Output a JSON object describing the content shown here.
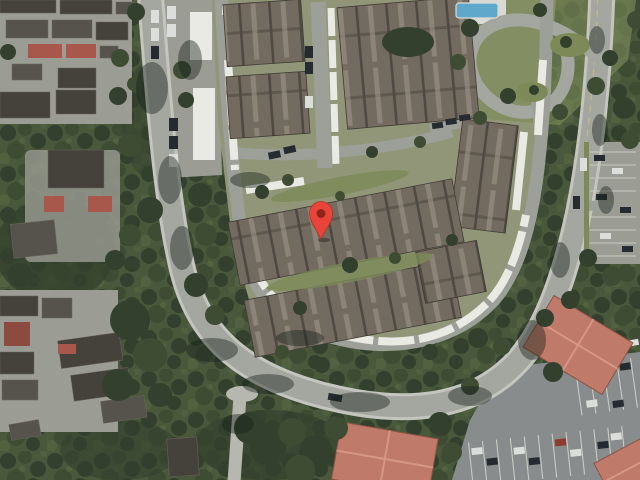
{
  "map": {
    "view_mode": "satellite",
    "marker": {
      "x": 321,
      "y": 239
    },
    "palette": {
      "canopy-base": "#49573b",
      "canopy-dark": "#33402e",
      "canopy-mid": "#3e4c34",
      "canopy-light": "#5b6b45",
      "lawn": "#7d8a58",
      "complex-lawn": "#929678",
      "curb": "#c3c5be",
      "road": "#a4a7a0",
      "road2": "#9da099",
      "path": "#b6b7af",
      "pavement": "#9b9c93",
      "asphalt": "#888c8c",
      "carport": "#e9eae3",
      "roof-main": "#746b60",
      "roof-dark": "#4e4942",
      "roof-light": "#9c9488",
      "roof-outline": "#3f3b35",
      "dark-roof": "#45423c",
      "mid-roof": "#55534b",
      "red-accent": "#a8584a",
      "roof-red": "#c07a69",
      "roof-red-dark": "#8e5246",
      "roof-red-light": "#d89a87",
      "pool": "#5fa8cb",
      "pool-deck": "#d9dad3",
      "car-dark": "#262b31",
      "car-light": "#dcdedb",
      "car-red": "#8e3b30",
      "paint-line": "#c9cbc4",
      "center-line": "#d9c26a",
      "shadow": "rgba(22,30,24,0.42)",
      "pin": "#e8443a",
      "pin-stroke": "#b8311f",
      "pin-dot": "#8e2318"
    }
  }
}
